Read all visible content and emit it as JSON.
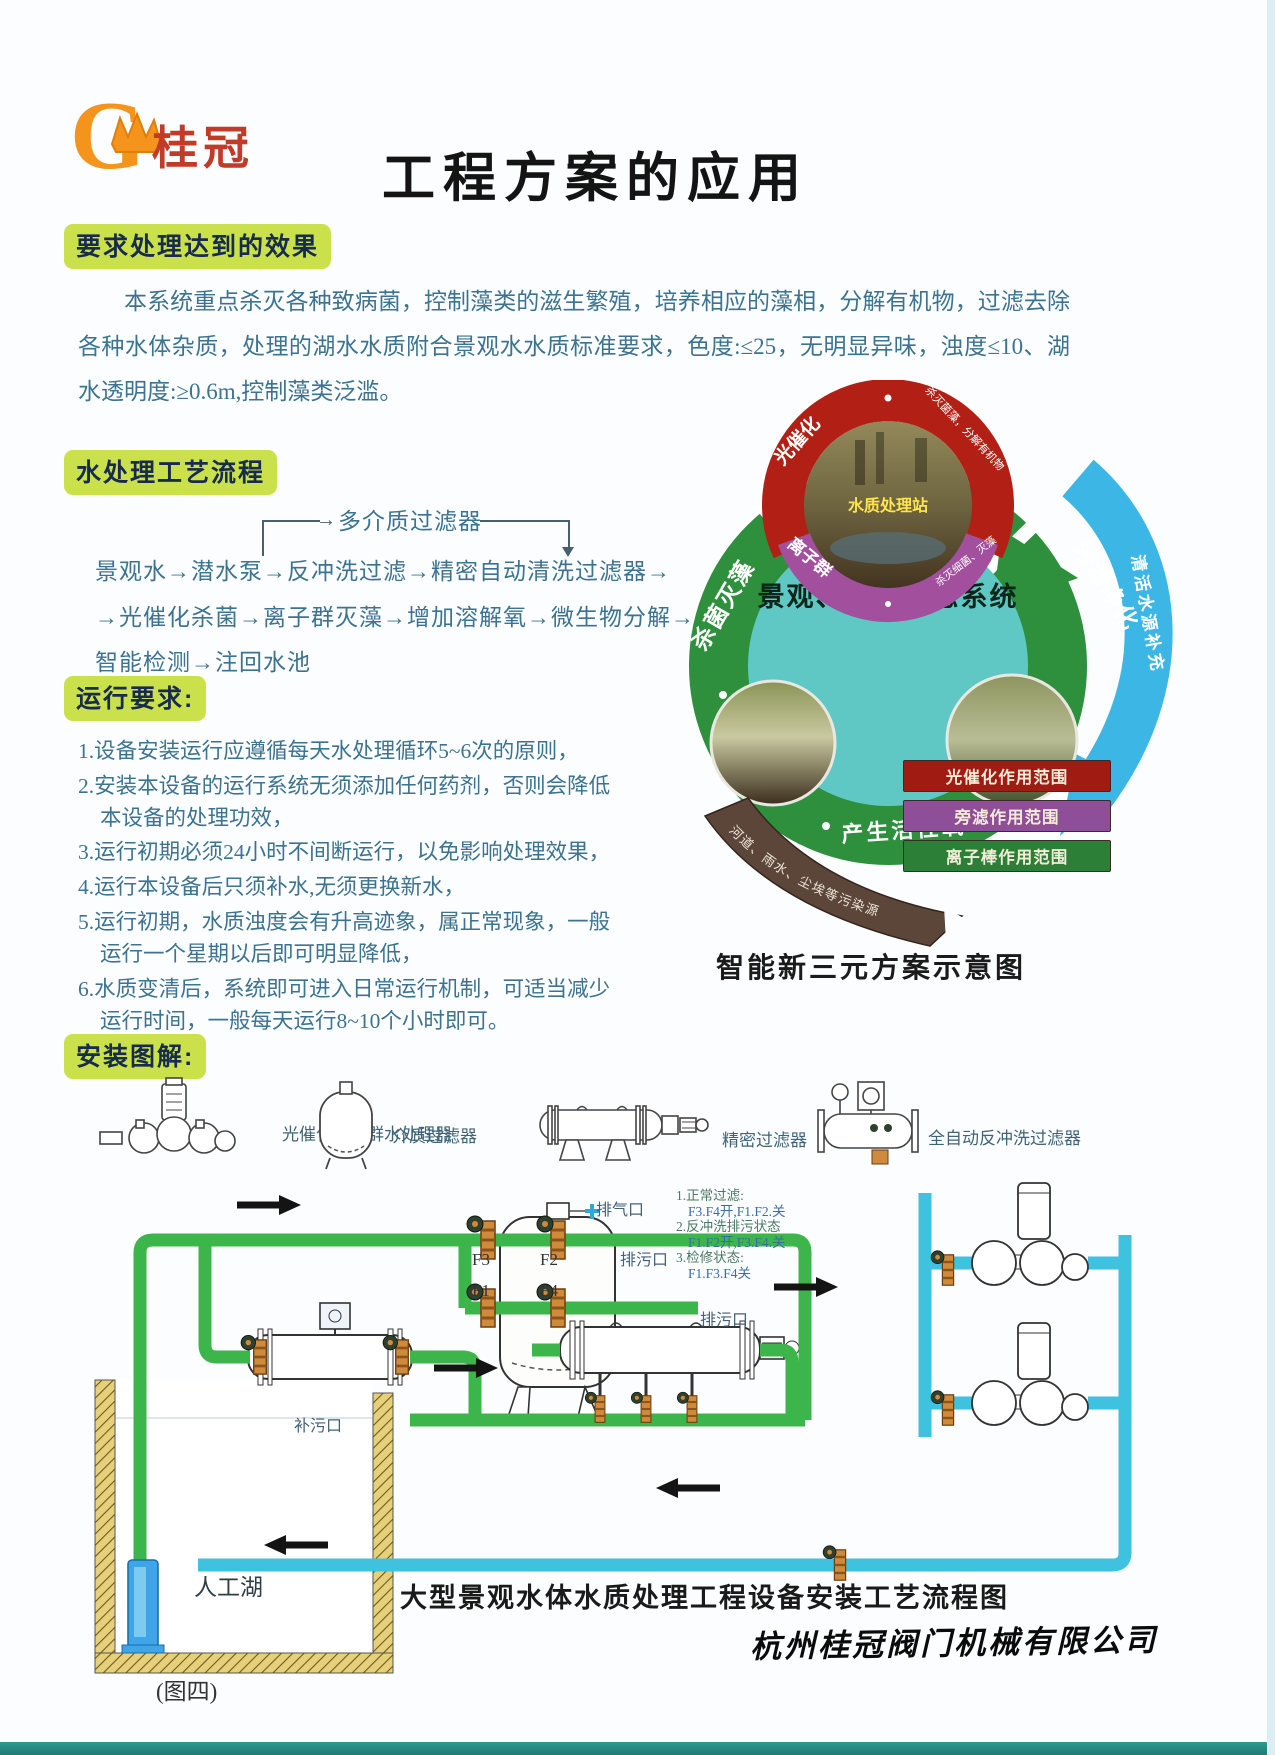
{
  "brand": {
    "g": "G",
    "name": "桂冠"
  },
  "title": "工程方案的应用",
  "colors": {
    "highlight": "#cbe14b",
    "pipe_green": "#3cb54b",
    "pipe_cyan": "#3fc1e0",
    "legend_red": "#a01c13",
    "legend_purple": "#8f4f98",
    "legend_green": "#2b7f37"
  },
  "sections": {
    "effect": {
      "heading": "要求处理达到的效果",
      "body": "本系统重点杀灭各种致病菌，控制藻类的滋生繁殖，培养相应的藻相，分解有机物，过滤去除各种水体杂质，处理的湖水水质附合景观水水质标准要求，色度:≤25，无明显异味，浊度≤10、湖水透明度:≥0.6m,控制藻类泛滥。"
    },
    "process": {
      "heading": "水处理工艺流程",
      "branch_arrow": "→",
      "branch_label": "多介质过滤器",
      "line1": "景观水→潜水泵→反冲洗过滤→精密自动清洗过滤器→",
      "line2": "→光催化杀菌→离子群灭藻→增加溶解氧→微生物分解→",
      "line3": "智能检测→注回水池"
    },
    "operation": {
      "heading": "运行要求:",
      "items": [
        "1.设备安装运行应遵循每天水处理循环5~6次的原则，",
        "2.安装本设备的运行系统无须添加任何药剂，否则会降低本设备的处理功效，",
        "3.运行初期必须24小时不间断运行，以免影响处理效果，",
        "4.运行本设备后只须补水,无须更换新水，",
        "5.运行初期，水质浊度会有升高迹象，属正常现象，一般运行一个星期以后即可明显降低，",
        "6.水质变清后，系统即可进入日常运行机制，可适当减少运行时间，一般每天运行8~10个小时即可。"
      ]
    },
    "install": {
      "heading": "安装图解:"
    }
  },
  "eco": {
    "center": "景观、鱼池生态系统",
    "station": "水质处理站",
    "photocatalysis": "光催化",
    "photocatalysis_note": "杀灭菌藻，分解有机物",
    "ion_group": "离子群",
    "ion_note": "杀灭细菌、灭藻",
    "left_arc": "杀菌灭藻",
    "right_arc": "旁滤净化",
    "bottom_arc": "产生活性氧",
    "blue_swoosh": "清活水源补充",
    "ribbon": "河道、雨水、尘埃等污染源",
    "legend": [
      {
        "label": "光催化作用范围",
        "color": "#a01c13"
      },
      {
        "label": "旁滤作用范围",
        "color": "#8f4f98"
      },
      {
        "label": "离子棒作用范围",
        "color": "#2b7f37"
      }
    ],
    "caption": "智能新三元方案示意图"
  },
  "equipment": {
    "labels": [
      "光催化离子群水处理器",
      "介质过滤器",
      "精密过滤器",
      "全自动反冲洗过滤器"
    ]
  },
  "piping": {
    "vent": "排气口",
    "f3": "F3",
    "f2": "F2",
    "f1": "F1",
    "f4": "F4",
    "drain_right": "排污口",
    "drain_center": "排污口",
    "fill_left": "补污口",
    "notes": [
      "1.正常过滤:",
      "F3.F4开,F1.F2.关",
      "2.反冲洗排污状态",
      "F1.F2开,F3.F4.关",
      "3.检修状态:",
      "F1.F3.F4关"
    ],
    "lake": "人工湖",
    "figure": "(图四)",
    "caption": "大型景观水体水质处理工程设备安装工艺流程图",
    "company": "杭州桂冠阀门机械有限公司"
  }
}
